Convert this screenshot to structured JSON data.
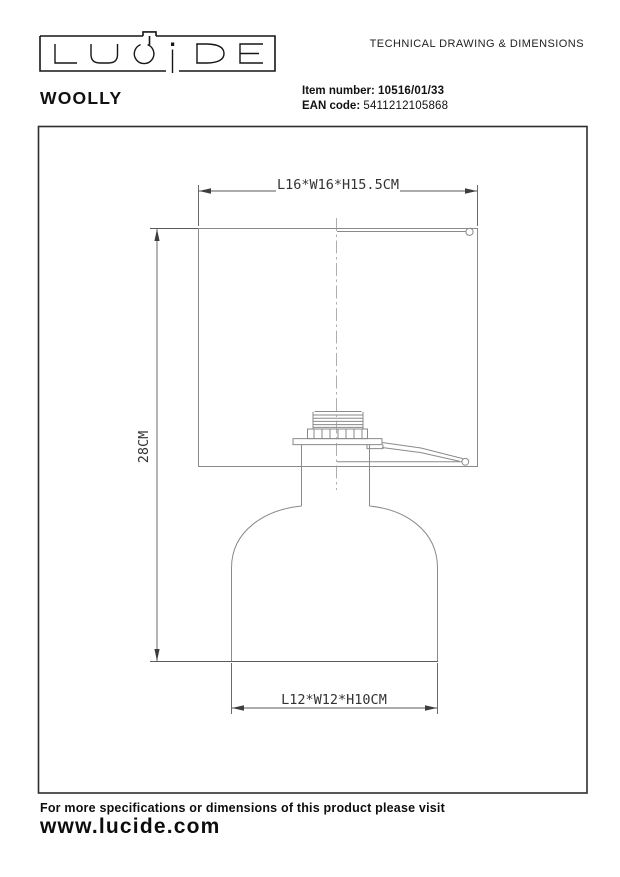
{
  "header": {
    "logo_text": "LUCIDE",
    "doc_title": "TECHNICAL DRAWING & DIMENSIONS",
    "product_name": "WOOLLY",
    "item_number_label": "Item number:",
    "item_number_value": "10516/01/33",
    "ean_label": "EAN code:",
    "ean_value": "5411212105868"
  },
  "drawing": {
    "dim_shade": "L16*W16*H15.5CM",
    "dim_height": "28CM",
    "dim_base": "L12*W12*H10CM"
  },
  "footer": {
    "note": "For more specifications or dimensions of this product please visit",
    "website": "www.lucide.com"
  },
  "colors": {
    "object_line": "#8a8a8a",
    "dimension_line": "#5a5a5a",
    "text": "#1f1f1f",
    "background": "#ffffff"
  }
}
